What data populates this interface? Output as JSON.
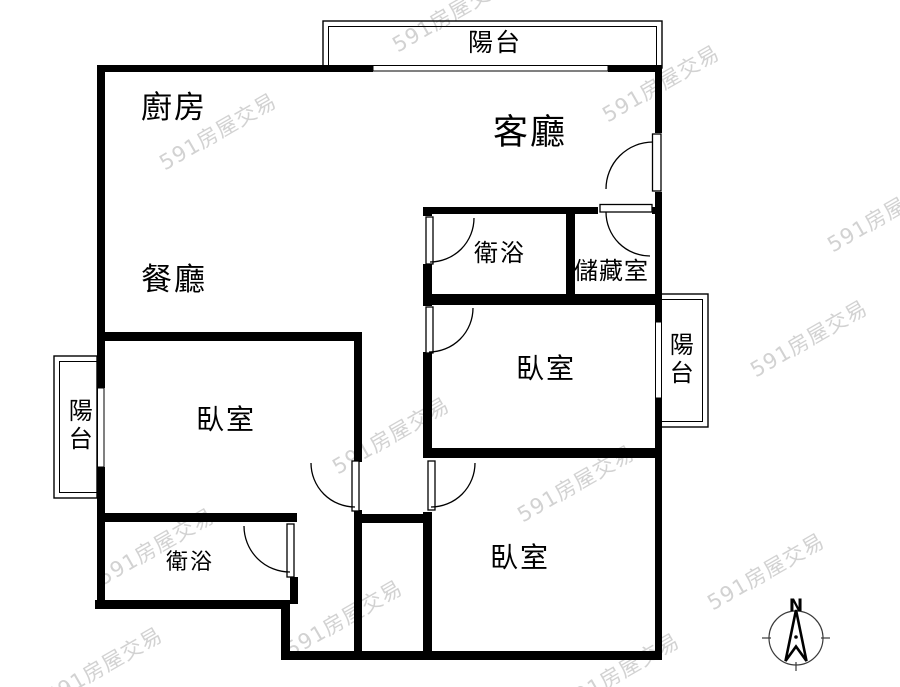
{
  "floorplan": {
    "rooms": {
      "kitchen": {
        "label": "廚房"
      },
      "living_room": {
        "label": "客廳"
      },
      "dining_room": {
        "label": "餐廳"
      },
      "bathroom_upper": {
        "label": "衛浴"
      },
      "storage": {
        "label": "儲藏室"
      },
      "bedroom_left": {
        "label": "臥室"
      },
      "bedroom_middle": {
        "label": "臥室"
      },
      "bedroom_bottom": {
        "label": "臥室"
      },
      "bathroom_lower": {
        "label": "衛浴"
      },
      "balcony_top": {
        "label": "陽台"
      },
      "balcony_left": {
        "label": "陽台"
      },
      "balcony_right": {
        "label": "陽台"
      }
    },
    "compass": {
      "north_label": "N"
    },
    "watermark": {
      "text": "591房屋交易",
      "color": "#d2d2d2"
    },
    "colors": {
      "wall": "#000000",
      "floor": "#ffffff",
      "balcony_line": "#000000"
    }
  }
}
